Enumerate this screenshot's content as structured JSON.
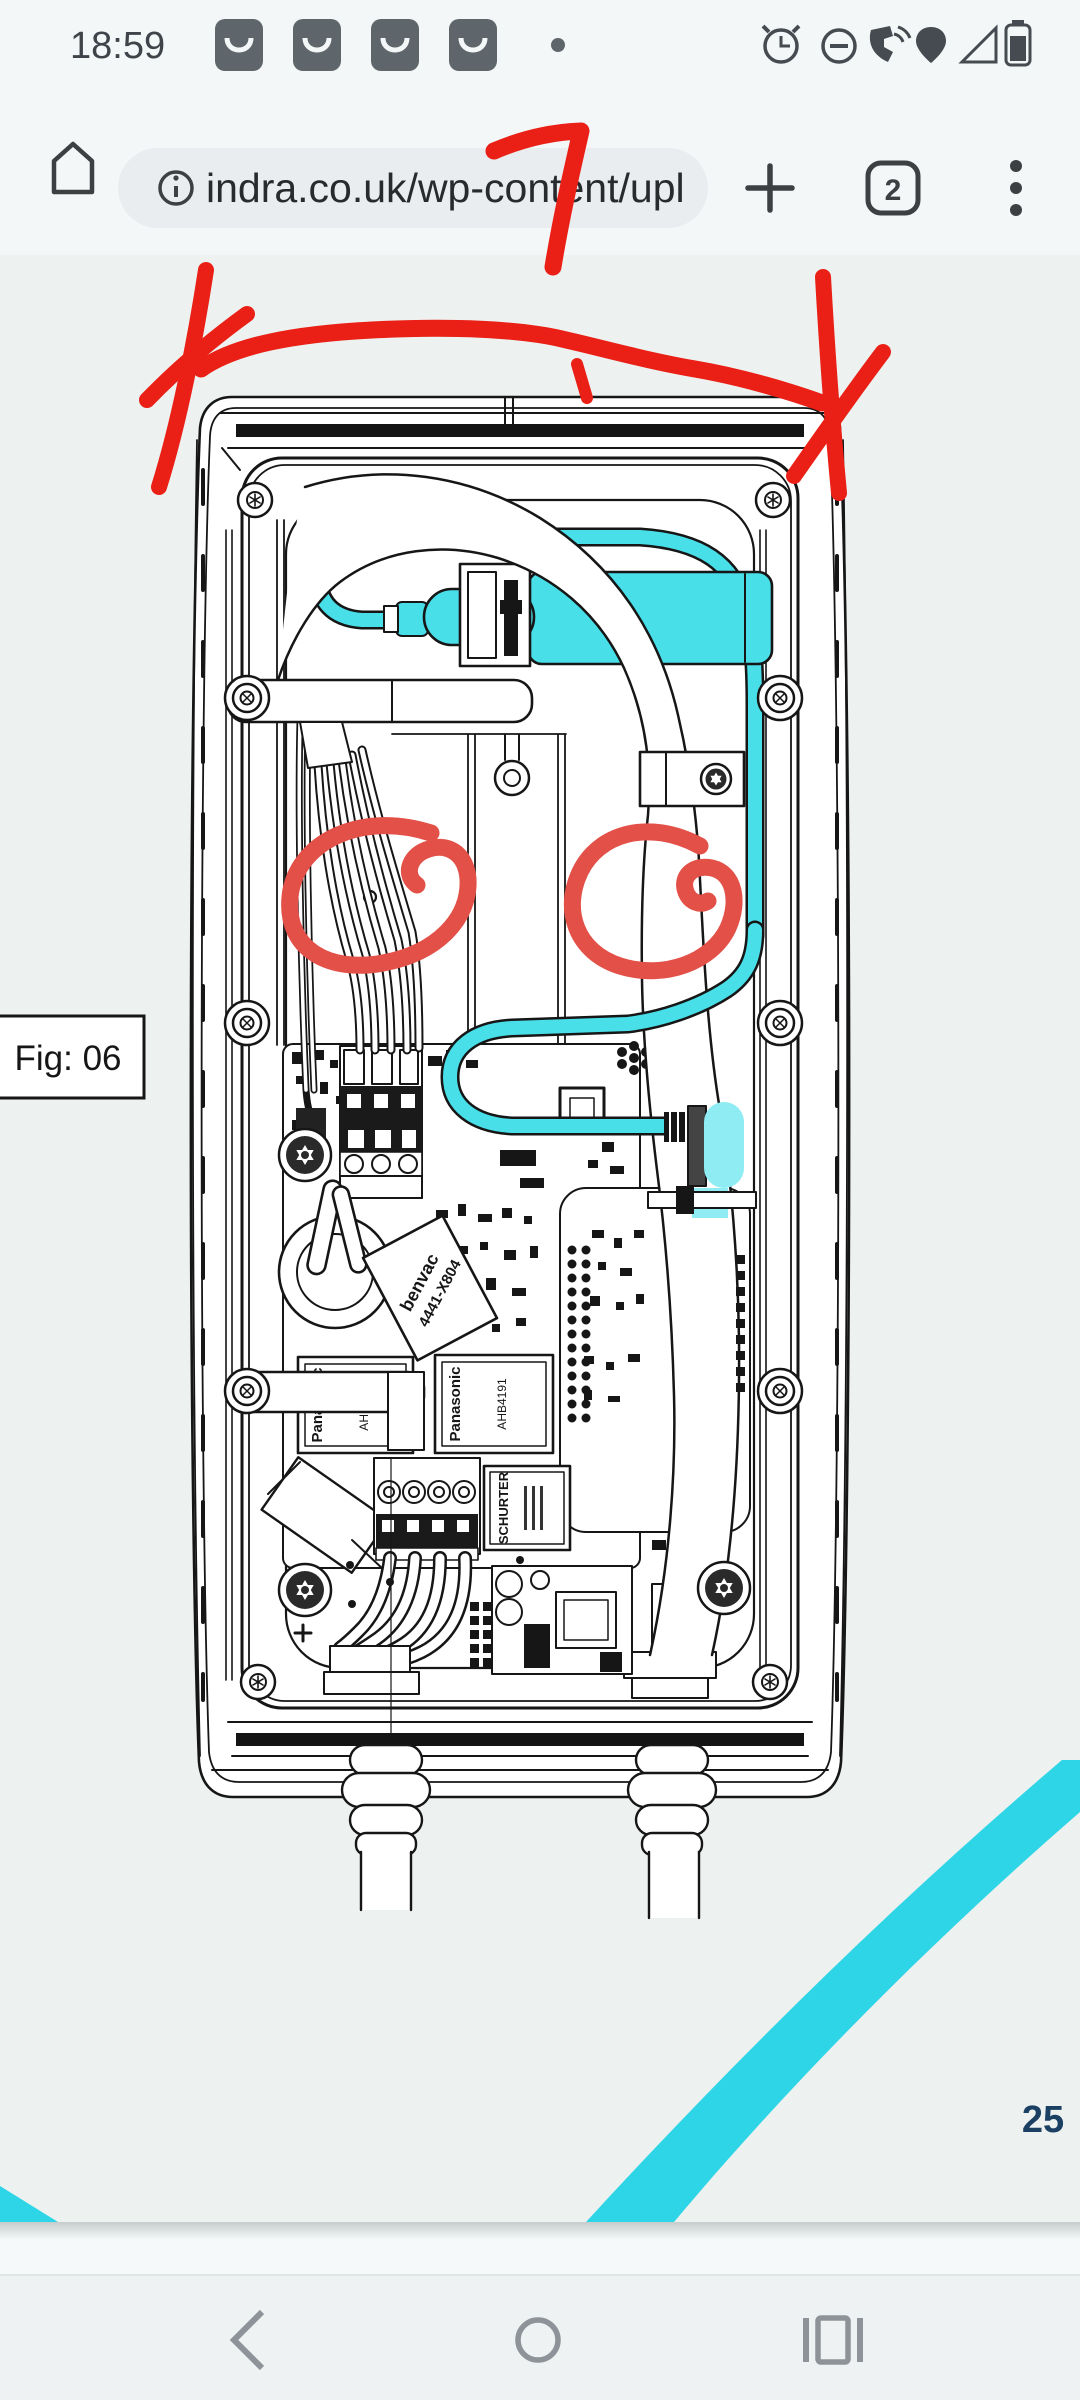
{
  "status_bar": {
    "time": "18:59",
    "icons": [
      "app-notification",
      "app-notification",
      "app-notification",
      "app-notification",
      "overflow-dot",
      "alarm-icon",
      "do-not-disturb-icon",
      "wifi-calling-icon",
      "vpn-pin-icon",
      "signal-empty-icon",
      "battery-icon"
    ]
  },
  "browser": {
    "url": "indra.co.uk/wp-content/upl",
    "tab_count": "2",
    "toolbar_icons": [
      "home",
      "site-info",
      "new-tab",
      "tab-switcher",
      "menu"
    ]
  },
  "document": {
    "figure_label": "Fig: 06",
    "page_number": "25",
    "drawing": "EV charger wallbox internal assembly drawing",
    "component_labels": {
      "toroid_brand": "benvac",
      "toroid_part": "4441-X804",
      "relay_brand": "Panasonic",
      "relay_part": "AHB4191",
      "fuse_brand": "SCHURTER"
    },
    "annotations": [
      "hand-drawn 7 over address bar",
      "red strike line with X at both ends",
      "red circle around left mounting hole",
      "red circle around right mounting hole"
    ],
    "colors": {
      "annotation_red": "#ea1f15",
      "annotation_salmon": "#e25048",
      "highlight_cyan": "#49dfe9",
      "stripe_cyan": "#2dd5e7",
      "page_number_navy": "#1c4063"
    }
  },
  "navigation_bar": {
    "icons": [
      "back",
      "home",
      "recents"
    ]
  }
}
